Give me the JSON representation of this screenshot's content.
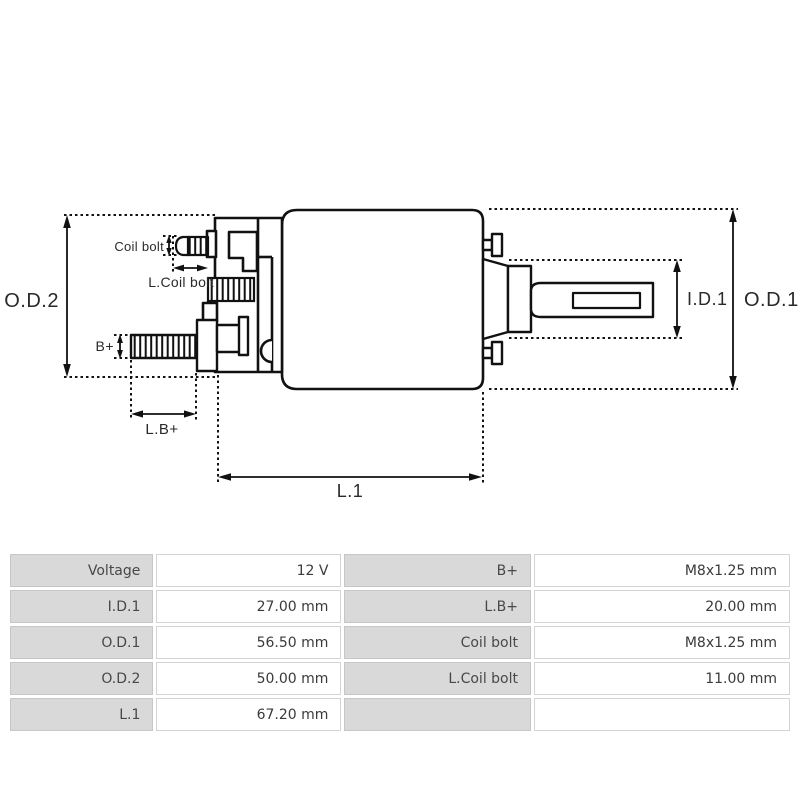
{
  "diagram": {
    "labels": {
      "od2": "O.D.2",
      "od1": "O.D.1",
      "id1": "I.D.1",
      "l1": "L.1",
      "lb_plus": "L.B+",
      "b_plus": "B+",
      "coil_bolt": "Coil bolt",
      "l_coil_bolt": "L.Coil bolt"
    }
  },
  "spec_table": {
    "rows": [
      {
        "label_left": "Voltage",
        "value_left": "12 V",
        "label_right": "B+",
        "value_right": "M8x1.25 mm"
      },
      {
        "label_left": "I.D.1",
        "value_left": "27.00 mm",
        "label_right": "L.B+",
        "value_right": "20.00 mm"
      },
      {
        "label_left": "O.D.1",
        "value_left": "56.50 mm",
        "label_right": "Coil bolt",
        "value_right": "M8x1.25 mm"
      },
      {
        "label_left": "O.D.2",
        "value_left": "50.00 mm",
        "label_right": "L.Coil bolt",
        "value_right": "11.00 mm"
      },
      {
        "label_left": "L.1",
        "value_left": "67.20 mm",
        "label_right": "",
        "value_right": ""
      }
    ]
  },
  "colors": {
    "line": "#111111",
    "label_text": "#2a2a2a",
    "table_label_bg": "#d9d9d9",
    "table_border": "#c6c6c6",
    "table_text": "#3a3a3a"
  }
}
